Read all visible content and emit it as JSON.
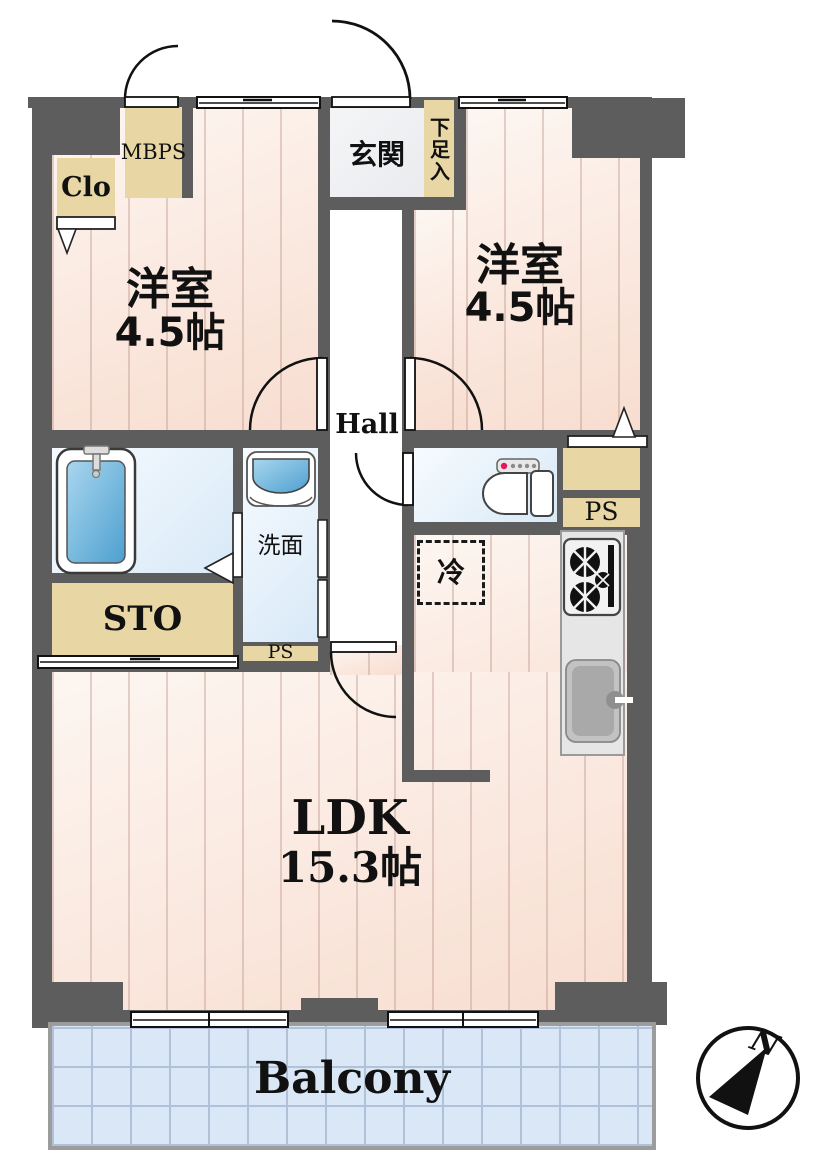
{
  "title": "apartment-floor-plan",
  "colors": {
    "wall": "#5d5d5d",
    "storage_tan": "#e8d7a4",
    "floor_stripe_light": "#fdf6f1",
    "floor_stripe_dark": "#f8ddd0",
    "water_room_blue": "#d8e9f7",
    "tub_blue": "#54a9d6",
    "balcony_fill": "#d9e7f7",
    "counter_gray": "#e6e6e6"
  },
  "rooms": {
    "bedroom_left": {
      "name": "洋室",
      "size": "4.5帖"
    },
    "bedroom_right": {
      "name": "洋室",
      "size": "4.5帖"
    },
    "ldk": {
      "name": "LDK",
      "size": "15.3帖"
    },
    "hall": {
      "label": "Hall"
    },
    "entrance": {
      "label": "玄関"
    },
    "washroom": {
      "label": "洗面"
    },
    "balcony": {
      "label": "Balcony"
    }
  },
  "storage": {
    "closet": "Clo",
    "meter_box": "MBPS",
    "shoe_box": "下足入",
    "storage_room": "STO",
    "pipe_space": "PS",
    "pipe_space_2": "PS"
  },
  "kitchen": {
    "refrigerator": "冷"
  },
  "compass": {
    "north": "N"
  },
  "fixtures": [
    "bathtub",
    "shower",
    "wash-basin",
    "toilet",
    "gas-stove",
    "kitchen-sink",
    "refrigerator-space"
  ]
}
